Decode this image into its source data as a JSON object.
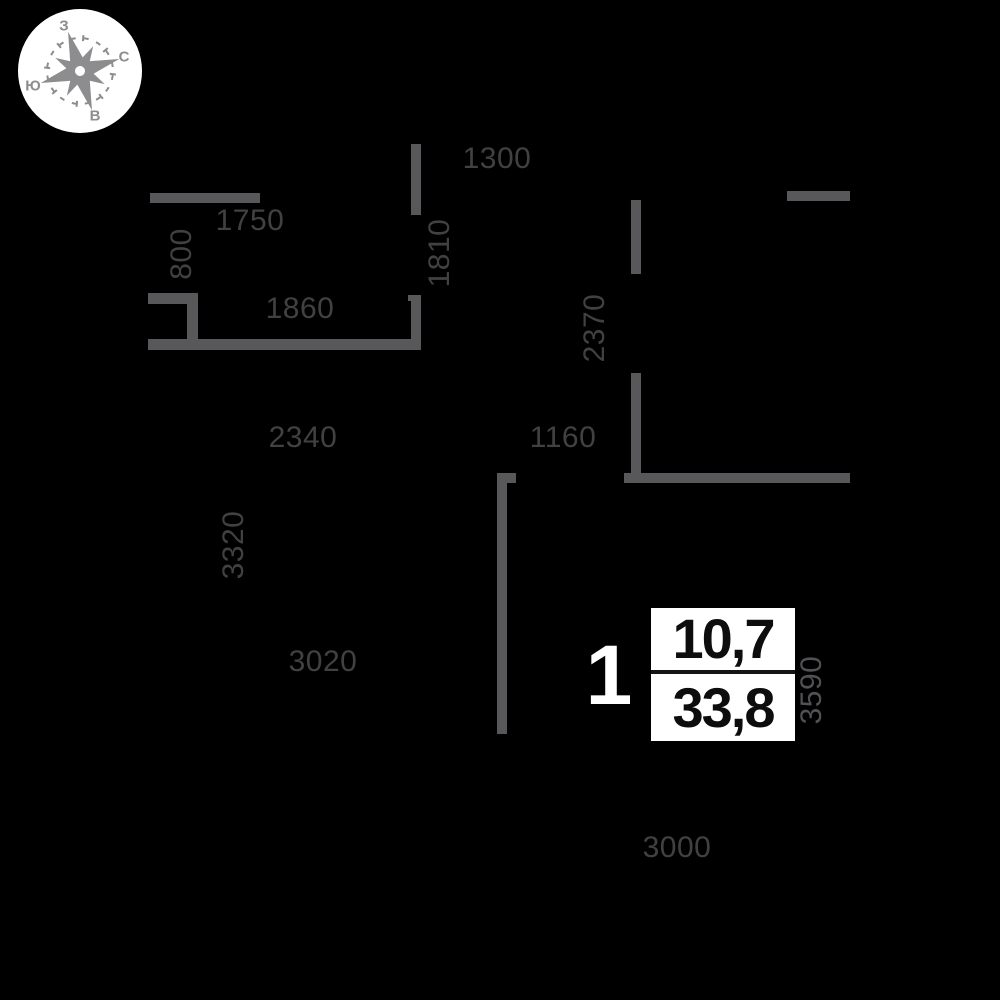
{
  "colors": {
    "background": "#000000",
    "wall": "#58585a",
    "dimension_text": "#414143",
    "dimension_text_light": "#515155",
    "compass": "#8d8d8f",
    "box_background": "#ffffff",
    "box_text": "#0d0d0d",
    "unit_text": "#ffffff"
  },
  "compass": {
    "rotation_deg": 73,
    "letters": {
      "top": "З",
      "right": "С",
      "left": "Ю",
      "bottom": "В"
    }
  },
  "apartment_info": {
    "rooms": "1",
    "living_area": "10,7",
    "total_area": "33,8"
  },
  "dimensions": [
    {
      "value": "1750",
      "x": 250,
      "y": 221,
      "vertical": false
    },
    {
      "value": "800",
      "x": 182,
      "y": 254,
      "vertical": true
    },
    {
      "value": "1300",
      "x": 497,
      "y": 159,
      "vertical": false
    },
    {
      "value": "1810",
      "x": 440,
      "y": 253,
      "vertical": true
    },
    {
      "value": "1860",
      "x": 300,
      "y": 309,
      "vertical": false
    },
    {
      "value": "2370",
      "x": 595,
      "y": 328,
      "vertical": true
    },
    {
      "value": "2340",
      "x": 303,
      "y": 438,
      "vertical": false
    },
    {
      "value": "1160",
      "x": 563,
      "y": 438,
      "vertical": false
    },
    {
      "value": "3320",
      "x": 234,
      "y": 545,
      "vertical": true
    },
    {
      "value": "3020",
      "x": 323,
      "y": 662,
      "vertical": false
    },
    {
      "value": "3590",
      "x": 812,
      "y": 690,
      "vertical": true,
      "light": true
    },
    {
      "value": "3000",
      "x": 677,
      "y": 848,
      "vertical": false
    }
  ],
  "walls": [
    {
      "x": 150,
      "y": 193,
      "w": 110,
      "h": 10
    },
    {
      "x": 411,
      "y": 144,
      "w": 10,
      "h": 71
    },
    {
      "x": 148,
      "y": 293,
      "w": 50,
      "h": 11
    },
    {
      "x": 187,
      "y": 293,
      "w": 11,
      "h": 57
    },
    {
      "x": 148,
      "y": 339,
      "w": 273,
      "h": 11
    },
    {
      "x": 408,
      "y": 295,
      "w": 13,
      "h": 6
    },
    {
      "x": 411,
      "y": 295,
      "w": 10,
      "h": 55
    },
    {
      "x": 631,
      "y": 200,
      "w": 10,
      "h": 74
    },
    {
      "x": 631,
      "y": 373,
      "w": 10,
      "h": 105
    },
    {
      "x": 624,
      "y": 473,
      "w": 226,
      "h": 10
    },
    {
      "x": 787,
      "y": 191,
      "w": 63,
      "h": 10
    },
    {
      "x": 497,
      "y": 473,
      "w": 10,
      "h": 261
    },
    {
      "x": 507,
      "y": 473,
      "w": 9,
      "h": 10
    }
  ]
}
